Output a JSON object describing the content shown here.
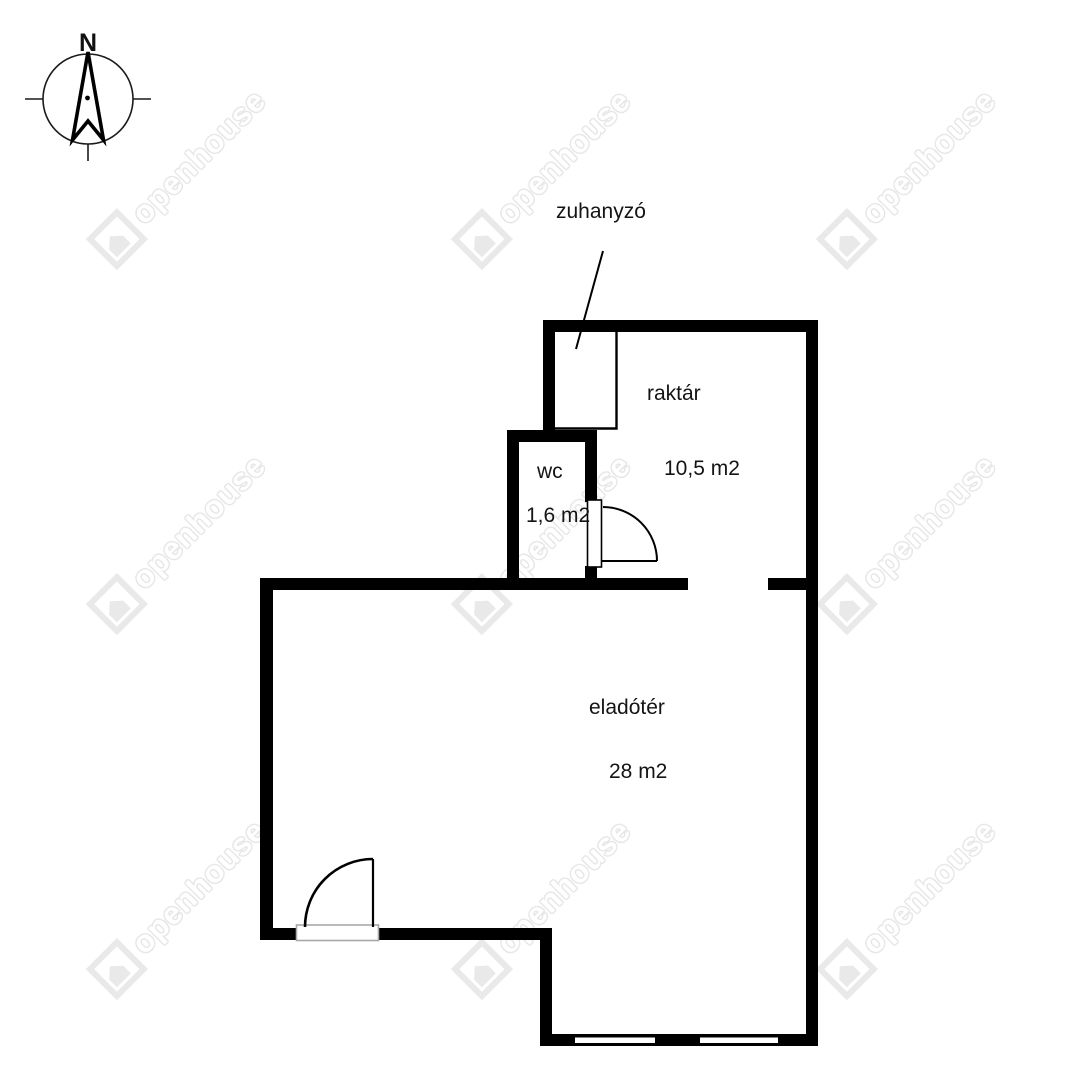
{
  "watermark": {
    "text": "openhouse"
  },
  "compass": {
    "north_label": "N"
  },
  "labels": {
    "zuhanyzo": "zuhanyzó",
    "raktar": "raktár",
    "raktar_area": "10,5 m2",
    "wc": "wc",
    "wc_area": "1,6 m2",
    "eladoter": "eladótér",
    "eladoter_area": "28 m2"
  },
  "colors": {
    "wall": "#000000",
    "label_text": "#141414",
    "watermark_gray": "#e7e7e7",
    "threshold_gray": "#a8a8a8"
  }
}
